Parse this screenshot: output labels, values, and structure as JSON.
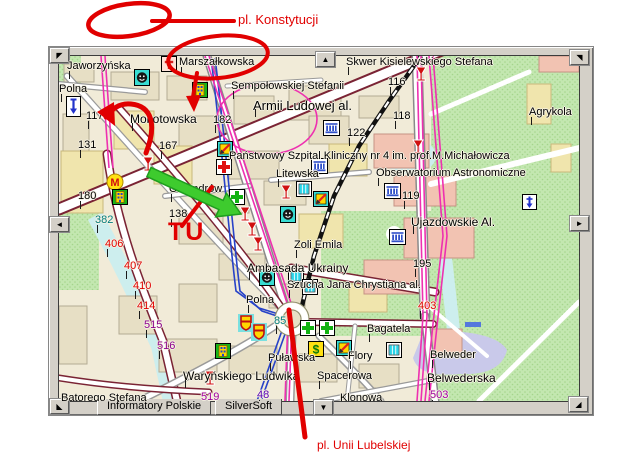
{
  "window": {
    "tabs": [
      {
        "label": "Informatory Polskie"
      },
      {
        "label": "SilverSoft"
      }
    ],
    "pan": {
      "nw": "◤",
      "n": "▲",
      "ne": "◥",
      "w": "◄",
      "e": "►",
      "sw": "◣",
      "s": "▼",
      "se": "◢"
    }
  },
  "annotations": {
    "color": "#e10000",
    "green_arrow_color": "#3ecb2e",
    "top_label": "pl. Konstytucji",
    "tu_label": "TU",
    "bottom_label": "pl. Unii Lubelskiej"
  },
  "map": {
    "street_labels": [
      {
        "text": "Jaworzyńska",
        "x": 8,
        "y": 4
      },
      {
        "text": "Polna",
        "x": 0,
        "y": 27
      },
      {
        "text": "Marszałkowska",
        "x": 120,
        "y": 0
      },
      {
        "text": "Sempołowskiej Stefanii",
        "x": 172,
        "y": 24
      },
      {
        "text": "Skwer Kisielewskiego Stefana",
        "x": 287,
        "y": 0
      },
      {
        "text": "Armii Ludowej al.",
        "x": 194,
        "y": 42,
        "size": 13
      },
      {
        "text": "Agrykola",
        "x": 470,
        "y": 50
      },
      {
        "text": "Mokotowska",
        "x": 71,
        "y": 56,
        "size": 12
      },
      {
        "text": "Państwowy Szpital Kliniczny nr 4 im. prof.M.Michałowicza",
        "x": 170,
        "y": 94
      },
      {
        "text": "Obserwatorium Astronomiczne",
        "x": 317,
        "y": 111
      },
      {
        "text": "Litewska",
        "x": 217,
        "y": 112
      },
      {
        "text": "Oleandrów",
        "x": 110,
        "y": 127
      },
      {
        "text": "Ujazdowskie Al.",
        "x": 352,
        "y": 159,
        "size": 12
      },
      {
        "text": "Zoli Emila",
        "x": 235,
        "y": 183
      },
      {
        "text": "Ambasada Ukrainy",
        "x": 188,
        "y": 205,
        "size": 12
      },
      {
        "text": "Szucha Jana Chrystiana al.",
        "x": 228,
        "y": 223
      },
      {
        "text": "Polna",
        "x": 187,
        "y": 238
      },
      {
        "text": "Puławska",
        "x": 209,
        "y": 296
      },
      {
        "text": "Bagatela",
        "x": 308,
        "y": 267
      },
      {
        "text": "Flory",
        "x": 289,
        "y": 294
      },
      {
        "text": "Spacerowa",
        "x": 258,
        "y": 314
      },
      {
        "text": "Klonowa",
        "x": 281,
        "y": 336
      },
      {
        "text": "Belweder",
        "x": 371,
        "y": 293
      },
      {
        "text": "Belwederska",
        "x": 368,
        "y": 315,
        "size": 12
      },
      {
        "text": "Waryńskiego Ludwika",
        "x": 124,
        "y": 313,
        "size": 12
      },
      {
        "text": "Batorego Stefana",
        "x": 2,
        "y": 336
      }
    ],
    "numbers": [
      {
        "text": "117",
        "x": 27,
        "y": 54,
        "color": "#000000"
      },
      {
        "text": "131",
        "x": 19,
        "y": 83,
        "color": "#000000"
      },
      {
        "text": "167",
        "x": 100,
        "y": 84,
        "color": "#000000"
      },
      {
        "text": "182",
        "x": 154,
        "y": 58,
        "color": "#000000"
      },
      {
        "text": "116",
        "x": 329,
        "y": 20,
        "color": "#000000"
      },
      {
        "text": "118",
        "x": 334,
        "y": 54,
        "color": "#000000"
      },
      {
        "text": "122",
        "x": 288,
        "y": 71,
        "color": "#000000"
      },
      {
        "text": "119",
        "x": 343,
        "y": 134,
        "color": "#000000"
      },
      {
        "text": "138",
        "x": 110,
        "y": 152,
        "color": "#000000"
      },
      {
        "text": "195",
        "x": 354,
        "y": 202,
        "color": "#000000"
      },
      {
        "text": "180",
        "x": 19,
        "y": 134,
        "color": "#000000"
      },
      {
        "text": "382",
        "x": 36,
        "y": 158,
        "color": "#007d7d"
      },
      {
        "text": "85",
        "x": 215,
        "y": 259,
        "color": "#007d7d"
      },
      {
        "text": "406",
        "x": 46,
        "y": 182,
        "color": "#e00000"
      },
      {
        "text": "407",
        "x": 65,
        "y": 204,
        "color": "#e00000"
      },
      {
        "text": "410",
        "x": 74,
        "y": 224,
        "color": "#e00000"
      },
      {
        "text": "414",
        "x": 78,
        "y": 244,
        "color": "#e00000"
      },
      {
        "text": "403",
        "x": 359,
        "y": 244,
        "color": "#e00000"
      },
      {
        "text": "515",
        "x": 85,
        "y": 263,
        "color": "#8c008c"
      },
      {
        "text": "516",
        "x": 98,
        "y": 284,
        "color": "#8c008c"
      },
      {
        "text": "48",
        "x": 198,
        "y": 333,
        "color": "#5a00b4"
      },
      {
        "text": "519",
        "x": 142,
        "y": 335,
        "color": "#a000a0"
      },
      {
        "text": "503",
        "x": 371,
        "y": 333,
        "color": "#a000a0"
      }
    ],
    "icons": [
      {
        "type": "church-icon",
        "x": 102,
        "y": 0
      },
      {
        "type": "theater-icon",
        "x": 75,
        "y": 13
      },
      {
        "type": "office-icon",
        "x": 133,
        "y": 26
      },
      {
        "type": "arrowbox-icon",
        "x": 7,
        "y": 40
      },
      {
        "type": "wine-icon",
        "x": 355,
        "y": 10
      },
      {
        "type": "bank-icon",
        "x": 264,
        "y": 64
      },
      {
        "type": "postal-icon",
        "x": 158,
        "y": 85
      },
      {
        "type": "hospital-icon",
        "x": 157,
        "y": 103
      },
      {
        "type": "wine-icon",
        "x": 220,
        "y": 128
      },
      {
        "type": "shop-icon",
        "x": 237,
        "y": 125
      },
      {
        "type": "postal-icon",
        "x": 254,
        "y": 135
      },
      {
        "type": "theater-icon",
        "x": 221,
        "y": 150
      },
      {
        "type": "pharmacy-icon",
        "x": 170,
        "y": 133
      },
      {
        "type": "wine-icon",
        "x": 179,
        "y": 150
      },
      {
        "type": "wine-icon",
        "x": 186,
        "y": 165
      },
      {
        "type": "wine-icon",
        "x": 192,
        "y": 180
      },
      {
        "type": "wine-icon",
        "x": 82,
        "y": 100
      },
      {
        "type": "metro-icon",
        "x": 47,
        "y": 117
      },
      {
        "type": "office-icon",
        "x": 53,
        "y": 133
      },
      {
        "type": "bank-icon",
        "x": 252,
        "y": 102
      },
      {
        "type": "bank-icon",
        "x": 325,
        "y": 127
      },
      {
        "type": "wine-icon",
        "x": 352,
        "y": 83
      },
      {
        "type": "parkarrow-icon",
        "x": 463,
        "y": 138
      },
      {
        "type": "bank-icon",
        "x": 330,
        "y": 173
      },
      {
        "type": "theater-icon",
        "x": 200,
        "y": 213
      },
      {
        "type": "shop-icon",
        "x": 229,
        "y": 212
      },
      {
        "type": "shop-icon",
        "x": 243,
        "y": 223
      },
      {
        "type": "shield-icon",
        "x": 179,
        "y": 258
      },
      {
        "type": "shield-icon",
        "x": 192,
        "y": 267
      },
      {
        "type": "pharmacy-icon",
        "x": 241,
        "y": 264
      },
      {
        "type": "pharmacy-icon",
        "x": 260,
        "y": 264
      },
      {
        "type": "dollar-icon",
        "x": 249,
        "y": 285
      },
      {
        "type": "postal-icon",
        "x": 277,
        "y": 284
      },
      {
        "type": "shop-icon",
        "x": 327,
        "y": 286
      },
      {
        "type": "office-icon",
        "x": 156,
        "y": 287
      },
      {
        "type": "wine-icon",
        "x": 144,
        "y": 314
      }
    ]
  }
}
